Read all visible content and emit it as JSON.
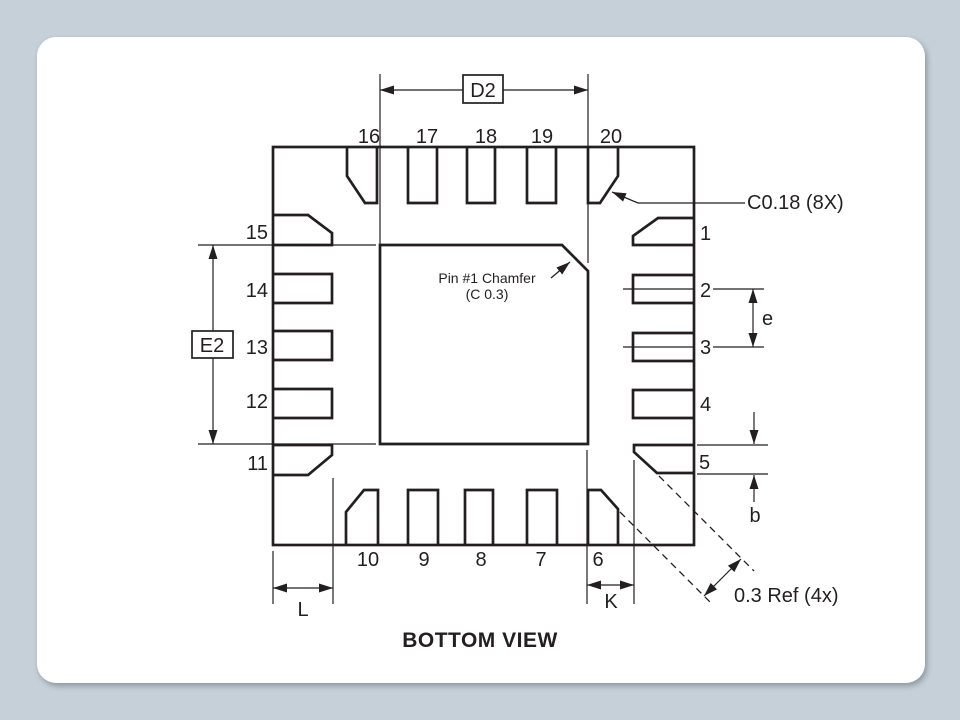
{
  "page": {
    "background_color": "#c6d0d8",
    "card_color": "#ffffff",
    "line_color": "#231f20"
  },
  "diagram": {
    "title": "BOTTOM VIEW",
    "pins": {
      "top": [
        "16",
        "17",
        "18",
        "19",
        "20"
      ],
      "right": [
        "1",
        "2",
        "3",
        "4",
        "5"
      ],
      "bottom": [
        "10",
        "9",
        "8",
        "7",
        "6"
      ],
      "left": [
        "15",
        "14",
        "13",
        "12",
        "11"
      ]
    },
    "dimensions": {
      "d2": "D2",
      "e2": "E2",
      "e": "e",
      "b": "b",
      "k": "K",
      "l": "L"
    },
    "annotations": {
      "corner_chamfer": "C0.18 (8X)",
      "pin1_chamfer_line1": "Pin #1 Chamfer",
      "pin1_chamfer_line2": "(C 0.3)",
      "corner_ref": "0.3 Ref (4x)"
    }
  }
}
